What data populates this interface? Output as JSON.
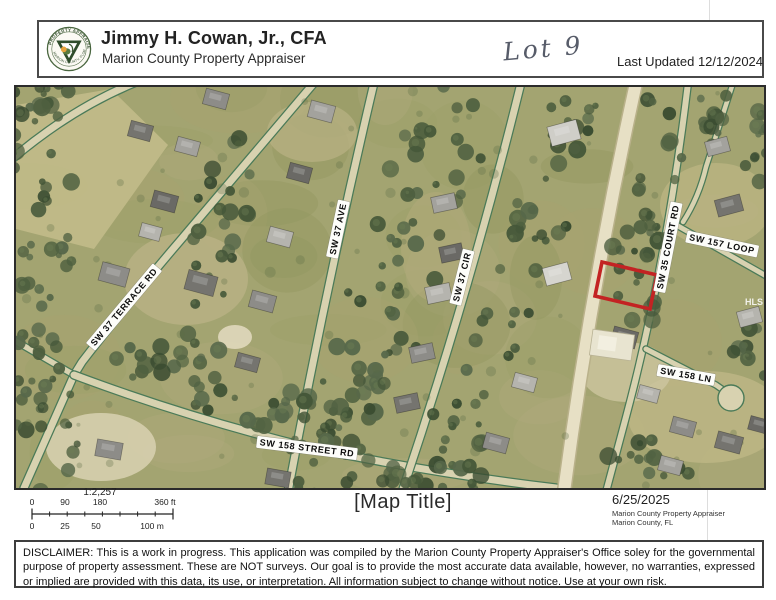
{
  "header": {
    "title": "Jimmy H. Cowan, Jr., CFA",
    "subtitle": "Marion County Property Appraiser",
    "handwritten_note": "Lot 9",
    "last_updated": "Last Updated 12/12/2024",
    "seal": {
      "ring_text_top": "PROPERTY APPRAISER",
      "ring_text_bottom": "MARION COUNTY, FLORIDA"
    }
  },
  "map": {
    "parcel_outline_color": "#c32323",
    "watermark": "HLS",
    "street_labels": [
      {
        "text": "SW 37 TERRACE RD"
      },
      {
        "text": "SW 37 AVE"
      },
      {
        "text": "SW 37 CIR"
      },
      {
        "text": "SW 35 COURT RD"
      },
      {
        "text": "SW 157 LOOP"
      },
      {
        "text": "SW 158 LN"
      },
      {
        "text": "SW 158 STREET RD"
      }
    ]
  },
  "footer": {
    "scale": {
      "ratio": "1:2,257",
      "feet_labels": [
        "0",
        "90",
        "180",
        "360 ft"
      ],
      "meter_labels": [
        "0",
        "25",
        "50",
        "100 m"
      ]
    },
    "map_title": "[Map Title]",
    "date": "6/25/2025",
    "attribution_line1": "Marion County Property Appraiser",
    "attribution_line2": "Marion County, FL"
  },
  "disclaimer": "DISCLAIMER: This is a work in progress. This application was compiled by the Marion County Property Appraiser's Office soley for the governmental purpose of property assessment. These are NOT surveys. Our goal is to provide the most accurate data available, however, no warranties, expressed or implied are provided with this data, its use, or interpretation. All information subject to change without notice. Use at your own risk."
}
